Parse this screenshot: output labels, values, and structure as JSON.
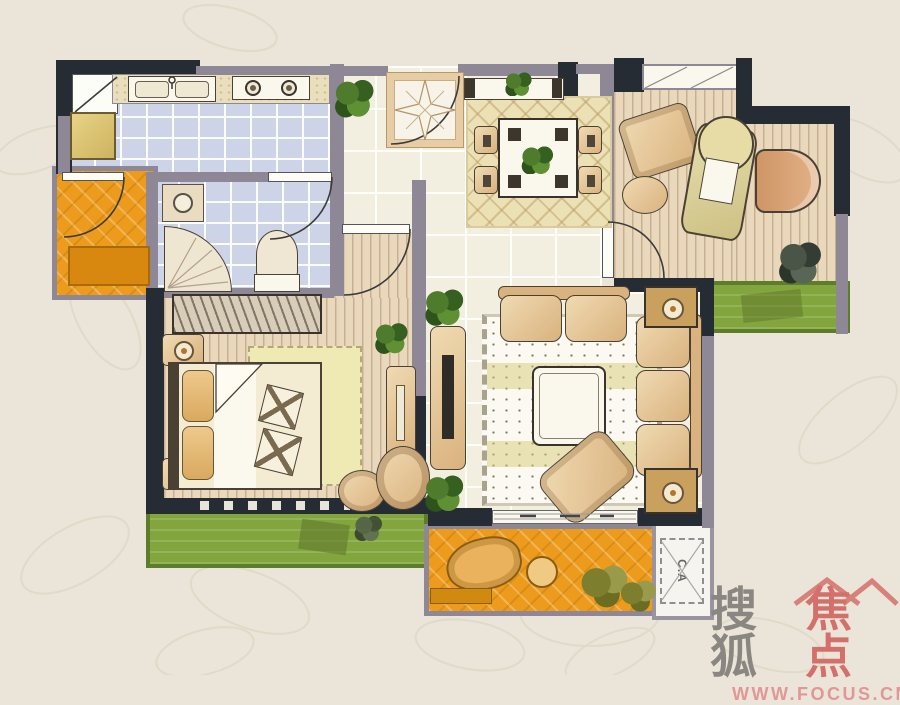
{
  "watermark": {
    "brand_gray": "搜狐",
    "brand_red": "焦点",
    "url": "WWW.FOCUS.CN",
    "brand_gray_color": "#8a8782",
    "brand_red_color": "#d4706b",
    "url_color": "#e39697"
  },
  "labels": {
    "ac_unit": "C.A"
  },
  "palette": {
    "background": "#eae5d8",
    "wall_dark": "#262c34",
    "wall_gray": "#8e8795",
    "tile_blue": "#cdd4e8",
    "floor_beige": "#f2efe0",
    "wood_floor": "#e9d8bc",
    "balcony_orange": "#ec9b1d",
    "garden_green": "#82a63d",
    "furniture_tan": "#e0bf92"
  },
  "floor_plan": {
    "rooms": [
      {
        "name": "kitchen",
        "features": [
          "counter",
          "double-sink",
          "gas-stove",
          "refrigerator",
          "door"
        ]
      },
      {
        "name": "bathroom",
        "features": [
          "washbasin",
          "shower",
          "toilet",
          "door"
        ]
      },
      {
        "name": "entry-hall",
        "features": [
          "entry-door",
          "compass-mat",
          "plant"
        ]
      },
      {
        "name": "dining-room",
        "features": [
          "sideboard",
          "dining-table",
          "four-chairs",
          "diamond-rug",
          "plant"
        ]
      },
      {
        "name": "study",
        "features": [
          "window",
          "desk",
          "desk-chair",
          "armchair",
          "ottoman",
          "plant",
          "door"
        ]
      },
      {
        "name": "bedroom",
        "features": [
          "wardrobe",
          "double-bed",
          "nightstands",
          "dresser",
          "stools",
          "rug",
          "plant"
        ]
      },
      {
        "name": "living-room",
        "features": [
          "tv-cabinet",
          "loveseat",
          "three-seat-sofa",
          "coffee-table",
          "chaise",
          "dotted-rug",
          "lamp-tables",
          "plants",
          "sliding-door"
        ]
      },
      {
        "name": "balcony-left",
        "features": [
          "door",
          "mat"
        ]
      },
      {
        "name": "balcony-bottom",
        "features": [
          "lounge-chair",
          "round-table",
          "plants",
          "step"
        ]
      },
      {
        "name": "ac-platform",
        "label": "C.A"
      },
      {
        "name": "garden-bed-bottom"
      },
      {
        "name": "garden-bed-right"
      }
    ]
  }
}
